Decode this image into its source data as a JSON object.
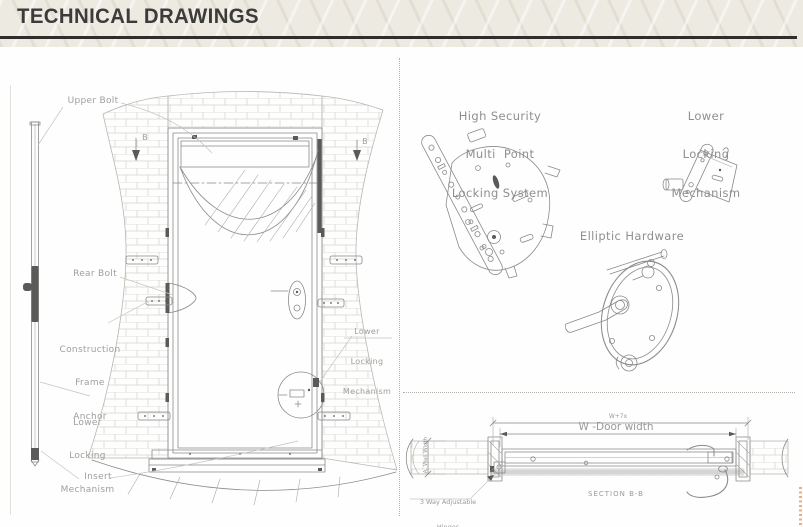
{
  "header": {
    "title": "TECHNICAL DRAWINGS"
  },
  "door_elevation": {
    "upper_bolt": "Upper Bolt",
    "rear_bolt": "Rear Bolt",
    "construction_frame_anchor": [
      "Construction",
      "Frame",
      "Anchor"
    ],
    "lower_locking_mechanism": [
      "Lower",
      "Locking",
      "Mechanism"
    ],
    "insert": "Insert",
    "door_lower_locking": [
      "Lower",
      "Locking",
      "Mechanism"
    ],
    "section_marker": "B"
  },
  "hardware": {
    "multi_point_title": [
      "High Security",
      "Multi  Point",
      "Locking System"
    ],
    "lower_locking_title": [
      "Lower",
      "Locking",
      "Mechanism"
    ],
    "elliptic_title": "Elliptic Hardware"
  },
  "section_bb": {
    "dim_overall": "W+7x",
    "dim_door_width": "W -Door width",
    "wall_width_label": "A. Wall Width",
    "hinges_label": [
      "3 Way Adjustable",
      "Hinges"
    ],
    "title": "SECTION B-B"
  },
  "colors": {
    "banner_bg": "#edeae1",
    "banner_text": "#3b3b39",
    "rule": "#2e2e2c",
    "drawing_line": "#8a8a8a",
    "label_text": "#9e9e9c",
    "accent_orange": "#f2aa76"
  }
}
